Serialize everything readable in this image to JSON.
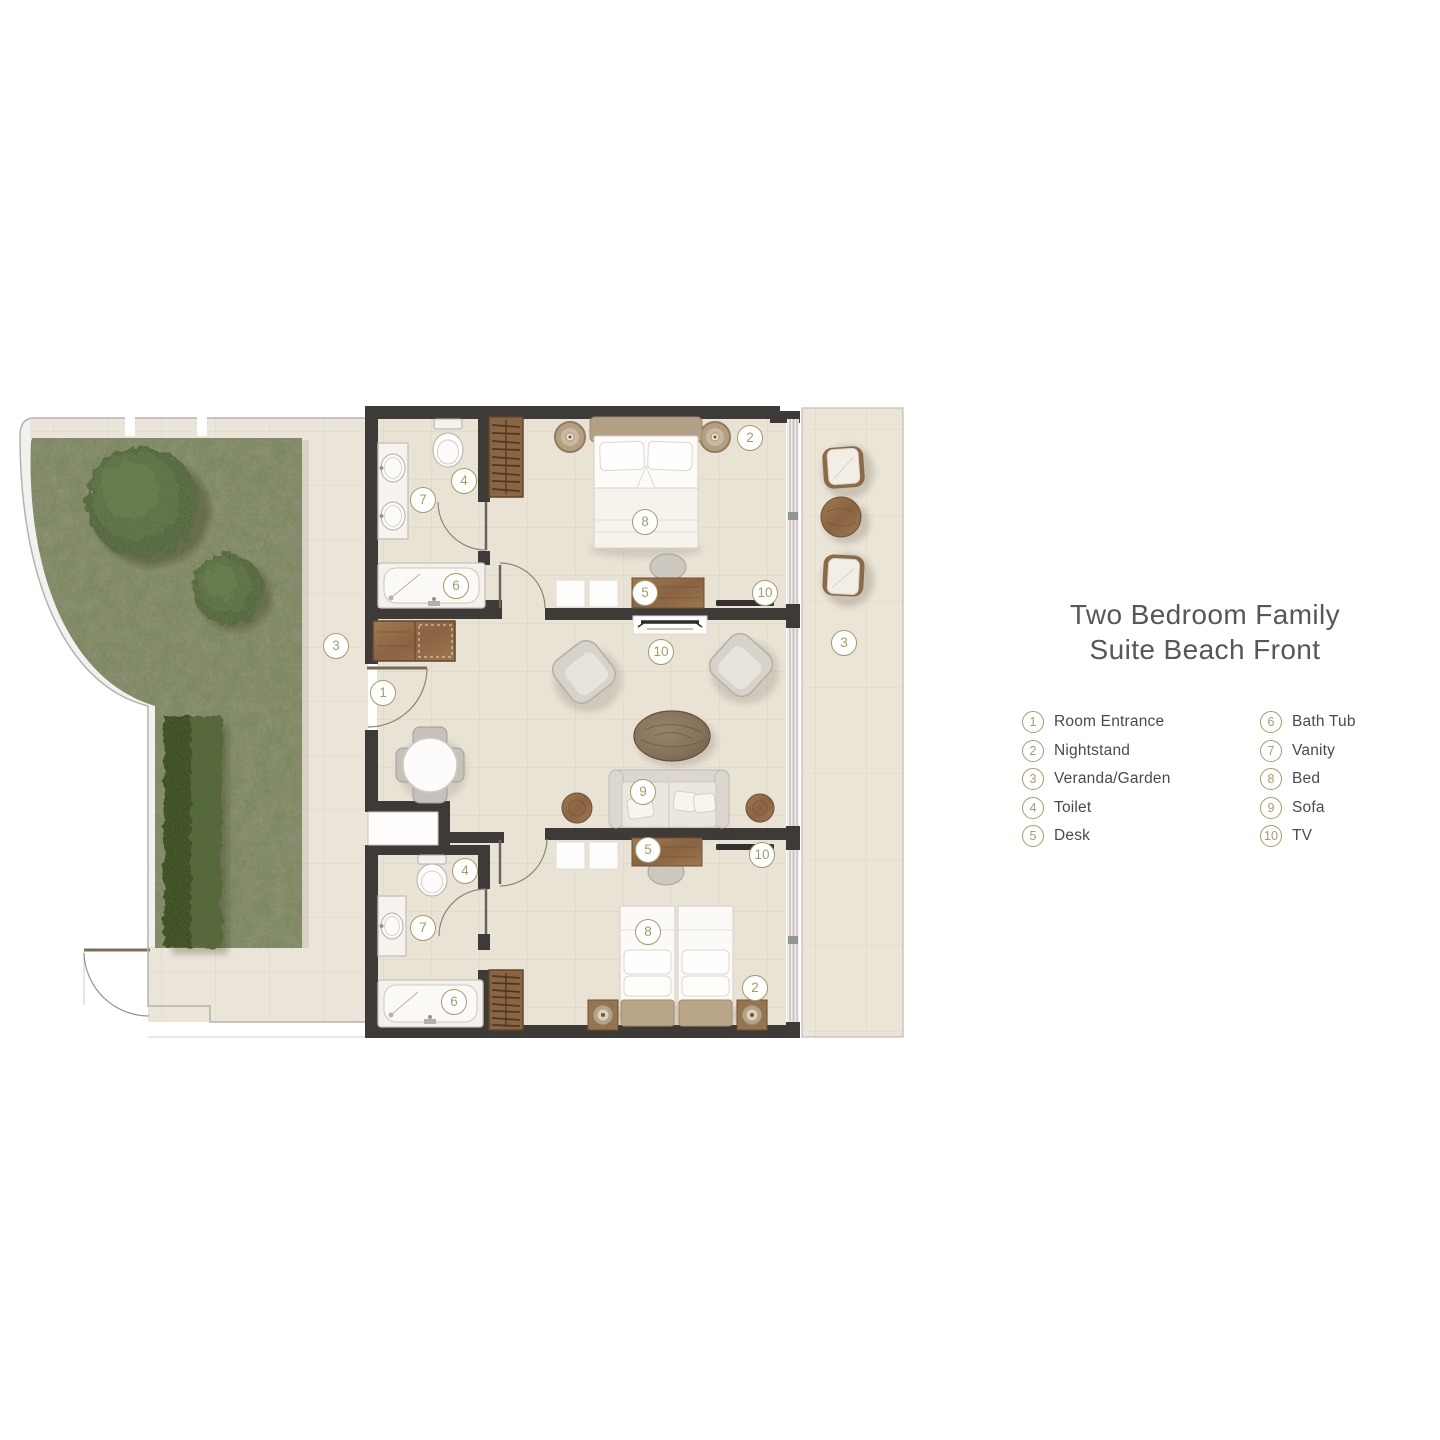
{
  "title": {
    "line1": "Two Bedroom Family",
    "line2": "Suite Beach Front"
  },
  "legend": {
    "items_left": [
      {
        "num": "1",
        "label": "Room Entrance"
      },
      {
        "num": "2",
        "label": "Nightstand"
      },
      {
        "num": "3",
        "label": "Veranda/Garden"
      },
      {
        "num": "4",
        "label": "Toilet"
      },
      {
        "num": "5",
        "label": "Desk"
      }
    ],
    "items_right": [
      {
        "num": "6",
        "label": "Bath Tub"
      },
      {
        "num": "7",
        "label": "Vanity"
      },
      {
        "num": "8",
        "label": "Bed"
      },
      {
        "num": "9",
        "label": "Sofa"
      },
      {
        "num": "10",
        "label": "TV"
      }
    ]
  },
  "plan": {
    "name": "two-bedroom-family-suite-beach-front-floor-plan",
    "markers": [
      {
        "n": "1",
        "label": "Room Entrance"
      },
      {
        "n": "2",
        "label": "Nightstand"
      },
      {
        "n": "8",
        "label": "Bed"
      },
      {
        "n": "5",
        "label": "Desk"
      },
      {
        "n": "10",
        "label": "TV"
      },
      {
        "n": "4",
        "label": "Toilet"
      },
      {
        "n": "7",
        "label": "Vanity"
      },
      {
        "n": "6",
        "label": "Bath Tub"
      },
      {
        "n": "3",
        "label": "Veranda/Garden"
      },
      {
        "n": "3",
        "label": "Veranda/Garden"
      },
      {
        "n": "10",
        "label": "TV"
      },
      {
        "n": "9",
        "label": "Sofa"
      },
      {
        "n": "5",
        "label": "Desk"
      },
      {
        "n": "10",
        "label": "TV"
      },
      {
        "n": "4",
        "label": "Toilet"
      },
      {
        "n": "7",
        "label": "Vanity"
      },
      {
        "n": "6",
        "label": "Bath Tub"
      },
      {
        "n": "8",
        "label": "Bed"
      },
      {
        "n": "2",
        "label": "Nightstand"
      }
    ]
  },
  "colors": {
    "accent_gold": "#a59c66",
    "wall": "#3e3a37",
    "floor_tile": "#e9e3d6",
    "grass": "#78825c",
    "wood": "#96714b",
    "title_text": "#56575a",
    "label_text": "#4a4a4c"
  }
}
